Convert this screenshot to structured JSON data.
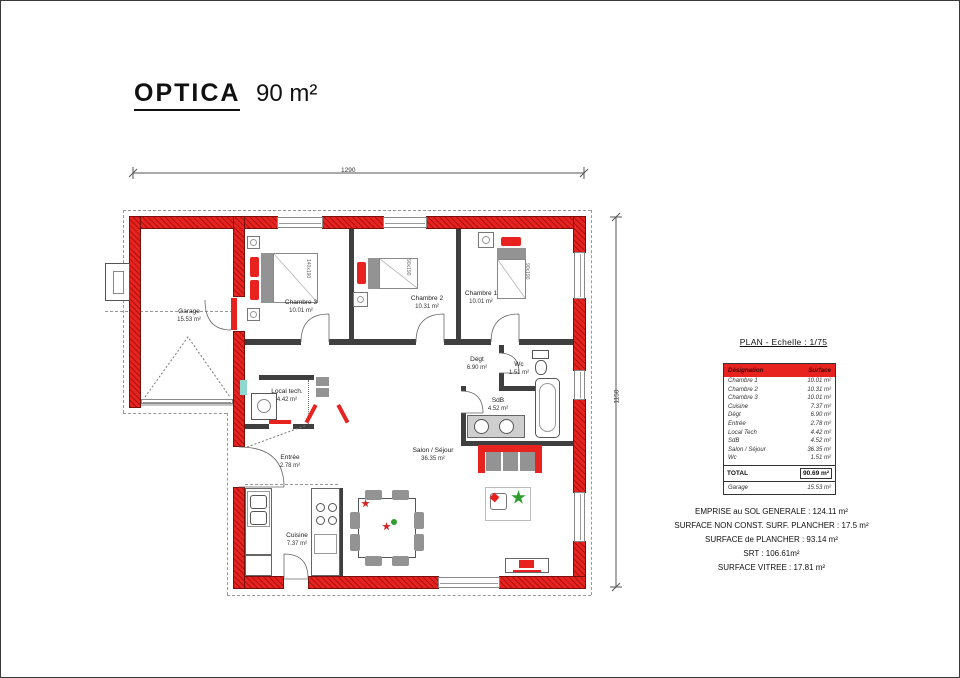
{
  "title": {
    "name": "OPTICA",
    "area": "90 m²"
  },
  "dimensions": {
    "width": "1290",
    "height": "1150"
  },
  "rooms": {
    "garage": {
      "name": "Garage",
      "area": "15.53 m²"
    },
    "chambre3": {
      "name": "Chambre 3",
      "area": "10.01 m²"
    },
    "chambre2": {
      "name": "Chambre 2",
      "area": "10.31 m²"
    },
    "chambre1": {
      "name": "Chambre 1",
      "area": "10.01 m²"
    },
    "degt": {
      "name": "Dégt",
      "area": "6.90 m²"
    },
    "wc": {
      "name": "Wc",
      "area": "1.51 m²"
    },
    "sdb": {
      "name": "SdB",
      "area": "4.52 m²"
    },
    "local_tech": {
      "name": "Local tech.",
      "area": "4.42 m²"
    },
    "entree": {
      "name": "Entrée",
      "area": "2.78 m²"
    },
    "cuisine": {
      "name": "Cuisine",
      "area": "7.37 m²"
    },
    "salon": {
      "name": "Salon / Séjour",
      "area": "36.35 m²"
    }
  },
  "beds": {
    "chambre3": "140x190",
    "chambre2": "90x190",
    "chambre1": "90x190"
  },
  "panel": {
    "plan_title": "PLAN - Echelle : 1/75",
    "table": {
      "header": {
        "designation": "Désignation",
        "surface": "Surface"
      },
      "rows": [
        {
          "d": "Chambre 1",
          "s": "10.01 m²"
        },
        {
          "d": "Chambre 2",
          "s": "10.31 m²"
        },
        {
          "d": "Chambre 3",
          "s": "10.01 m²"
        },
        {
          "d": "Cuisine",
          "s": "7.37 m²"
        },
        {
          "d": "Dégt",
          "s": "6.90 m²"
        },
        {
          "d": "Entrée",
          "s": "2.78 m²"
        },
        {
          "d": "Local Tech",
          "s": "4.42 m²"
        },
        {
          "d": "SdB",
          "s": "4.52 m²"
        },
        {
          "d": "Salon / Séjour",
          "s": "36.35 m²"
        },
        {
          "d": "Wc",
          "s": "1.51 m²"
        }
      ],
      "total": {
        "label": "TOTAL",
        "value": "90.69 m²"
      },
      "garage": {
        "label": "Garage",
        "value": "15.53 m²"
      }
    },
    "summary": [
      "EMPRISE au SOL GENERALE : 124.11 m²",
      "SURFACE NON CONST. SURF. PLANCHER : 17.5 m²",
      "SURFACE de PLANCHER : 93.14 m²",
      "SRT : 106.61m²",
      "SURFACE VITREE : 17.81 m²"
    ]
  },
  "colors": {
    "wall_red": "#e8231f",
    "partition": "#3f3f3f"
  }
}
